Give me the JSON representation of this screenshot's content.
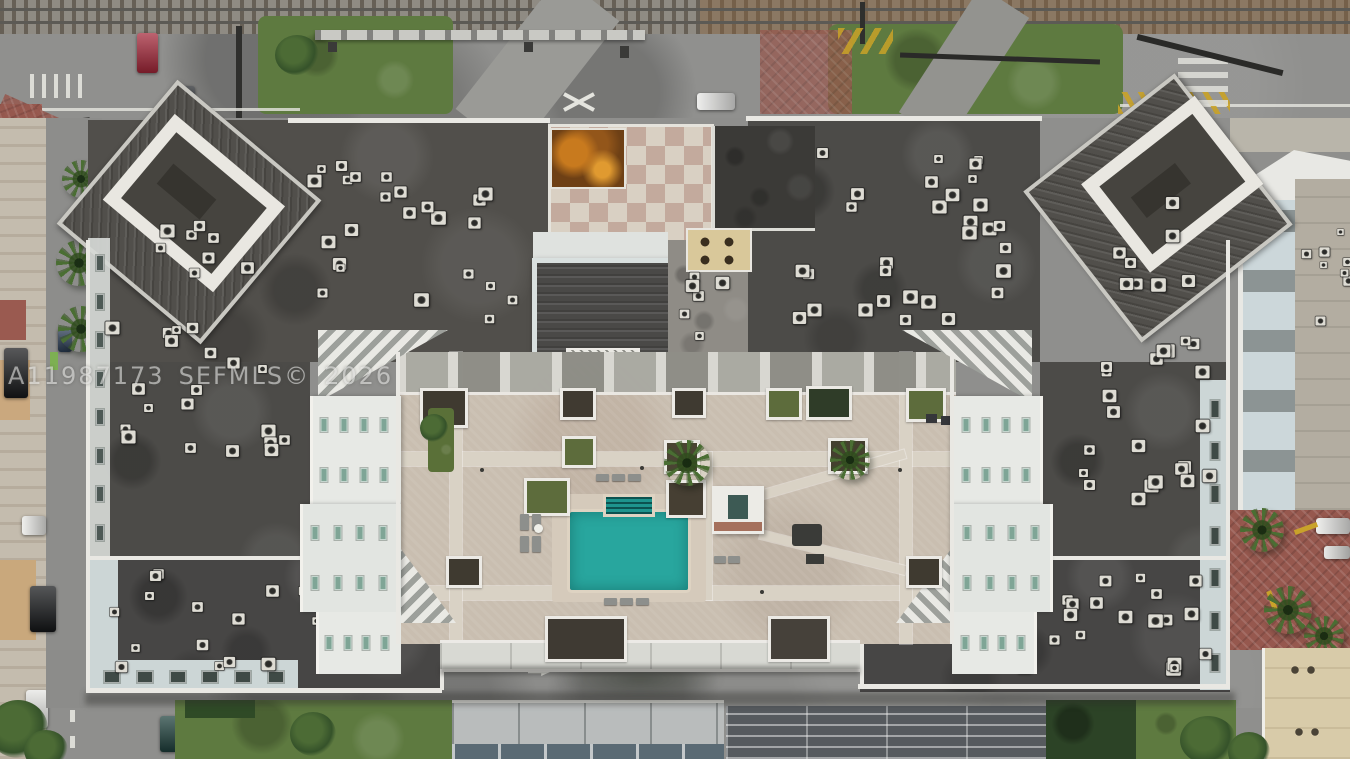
{
  "image": {
    "type": "aerial-drone-photo",
    "description": "Top-down aerial view of a large condominium building with dark rooftops covered in AC units, a central paver courtyard with a teal swimming pool, surrounded by streets, a railroad corridor at top, palm-lined street at left and neighboring buildings"
  },
  "watermark": {
    "listing_id": "A11987173",
    "mls_text": "SEFMLS©",
    "year": "2026"
  },
  "colors": {
    "pool": "#28a69e",
    "pool_steps": "#1e948d",
    "roof": "#4c4b48",
    "paver": "#c9beb0",
    "parapet": "#e9e8e3",
    "asphalt": "#8f8f8d",
    "grass": "#5e7a40",
    "brick": "#96584e",
    "checker_light": "#d9d0c3",
    "checker_dark": "#c3aa9d",
    "rust": "#6e4015",
    "window_teal": "#7fa596",
    "pale_wall": "#ccd6d6",
    "beige_roof": "#d8cba9"
  }
}
